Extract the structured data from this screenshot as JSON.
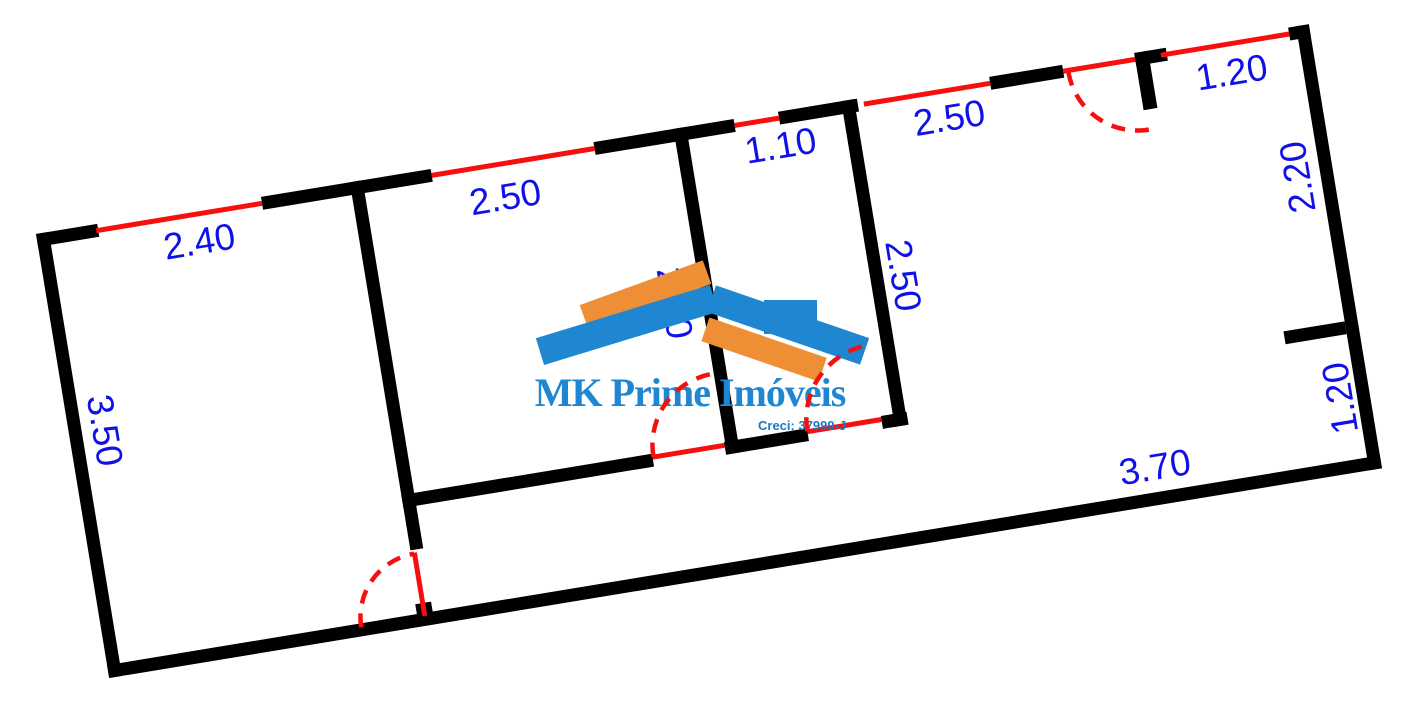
{
  "watermark": {
    "title": "MK Prime Imóveis",
    "creci": "Creci: 37999-J"
  },
  "colors": {
    "wall": "#000000",
    "opening_red": "#f50f0f",
    "dimension_blue": "#1010e8",
    "logo_blue": "#1f86d2",
    "logo_orange": "#ef8f35"
  },
  "plan": {
    "rotation_deg": -9.36,
    "origin": {
      "x": 36,
      "y": 234
    },
    "size": {
      "w": 1290,
      "h": 450
    },
    "walls": [
      {
        "x": 0,
        "y": 0,
        "w": 62,
        "h": 13
      },
      {
        "x": 228,
        "y": 0,
        "w": 172,
        "h": 13
      },
      {
        "x": 565,
        "y": 0,
        "w": 142,
        "h": 13
      },
      {
        "x": 752,
        "y": 0,
        "w": 80,
        "h": 13
      },
      {
        "x": 966,
        "y": 0,
        "w": 74,
        "h": 13
      },
      {
        "x": 1113,
        "y": 0,
        "w": 32,
        "h": 13
      },
      {
        "x": 1113,
        "y": 0,
        "w": 14,
        "h": 58
      },
      {
        "x": 1269,
        "y": 0,
        "w": 21,
        "h": 13
      },
      {
        "x": 0,
        "y": 0,
        "w": 13,
        "h": 450
      },
      {
        "x": 1277,
        "y": 0,
        "w": 13,
        "h": 450
      },
      {
        "x": 0,
        "y": 437,
        "w": 1290,
        "h": 13
      },
      {
        "x": 318,
        "y": 0,
        "w": 13,
        "h": 373
      },
      {
        "x": 646,
        "y": 0,
        "w": 13,
        "h": 330
      },
      {
        "x": 816,
        "y": 0,
        "w": 13,
        "h": 330
      },
      {
        "x": 318,
        "y": 317,
        "w": 254,
        "h": 13
      },
      {
        "x": 645,
        "y": 317,
        "w": 84,
        "h": 13
      },
      {
        "x": 804,
        "y": 317,
        "w": 26,
        "h": 13
      },
      {
        "x": 1215,
        "y": 299,
        "w": 62,
        "h": 13
      },
      {
        "x": 314,
        "y": 427,
        "w": 16,
        "h": 11
      }
    ],
    "windows": [
      {
        "x": 60,
        "y": 4,
        "len": 168
      },
      {
        "x": 400,
        "y": 4,
        "len": 165
      },
      {
        "x": 707,
        "y": 4,
        "len": 45
      },
      {
        "x": 838,
        "y": 4,
        "len": 128
      },
      {
        "x": 1139,
        "y": 4,
        "len": 130
      }
    ],
    "door_leaves": [
      {
        "x": 572,
        "y": 318,
        "w": 73,
        "h": 5
      },
      {
        "x": 729,
        "y": 318,
        "w": 75,
        "h": 5
      },
      {
        "x": 319,
        "y": 376,
        "w": 5,
        "h": 64
      },
      {
        "x": 1040,
        "y": 4,
        "w": 73,
        "h": 5
      }
    ],
    "door_arcs": [
      {
        "path": "M 573 320 A 72 72 0 0 1 645 248"
      },
      {
        "path": "M 729 320 A 75 75 0 0 1 804 245"
      },
      {
        "path": "M 257 441 A 64 64 0 0 1 321 377"
      },
      {
        "path": "M 1045 8 A 70 70 0 0 0 1115 78"
      }
    ],
    "dimensions": [
      {
        "text": "2.40",
        "x": 160,
        "y": 34,
        "rot": 0
      },
      {
        "text": "2.50",
        "x": 469,
        "y": 40,
        "rot": 0
      },
      {
        "text": "1.10",
        "x": 749,
        "y": 34,
        "rot": 0
      },
      {
        "text": "2.50",
        "x": 920,
        "y": 34,
        "rot": 0
      },
      {
        "text": "1.20",
        "x": 1206,
        "y": 35,
        "rot": 0
      },
      {
        "text": "2.20",
        "x": 1254,
        "y": 149,
        "rot": -90
      },
      {
        "text": "1.20",
        "x": 1260,
        "y": 374,
        "rot": -90
      },
      {
        "text": "3.70",
        "x": 1066,
        "y": 412,
        "rot": 0
      },
      {
        "text": "3.50",
        "x": 36,
        "y": 205,
        "rot": 90
      },
      {
        "text": "2.50",
        "x": 619,
        "y": 172,
        "rot": 90
      },
      {
        "text": "2.50",
        "x": 849,
        "y": 182,
        "rot": 90
      }
    ]
  },
  "logo_shapes": {
    "stripe_upper_orange": {
      "left": 80,
      "top": 27,
      "w": 131,
      "h": 25,
      "rot": -20
    },
    "roof_left_blue": {
      "left": 36,
      "top": 56,
      "w": 182,
      "h": 28,
      "rot": -17
    },
    "roof_right_blue": {
      "left": 207,
      "top": 56,
      "w": 162,
      "h": 28,
      "rot": 19
    },
    "chimney_blue": {
      "left": 264,
      "top": 45,
      "w": 53,
      "h": 34,
      "rot": 0
    },
    "stripe_lower_orange": {
      "left": 202,
      "top": 82,
      "w": 124,
      "h": 25,
      "rot": 19
    }
  }
}
